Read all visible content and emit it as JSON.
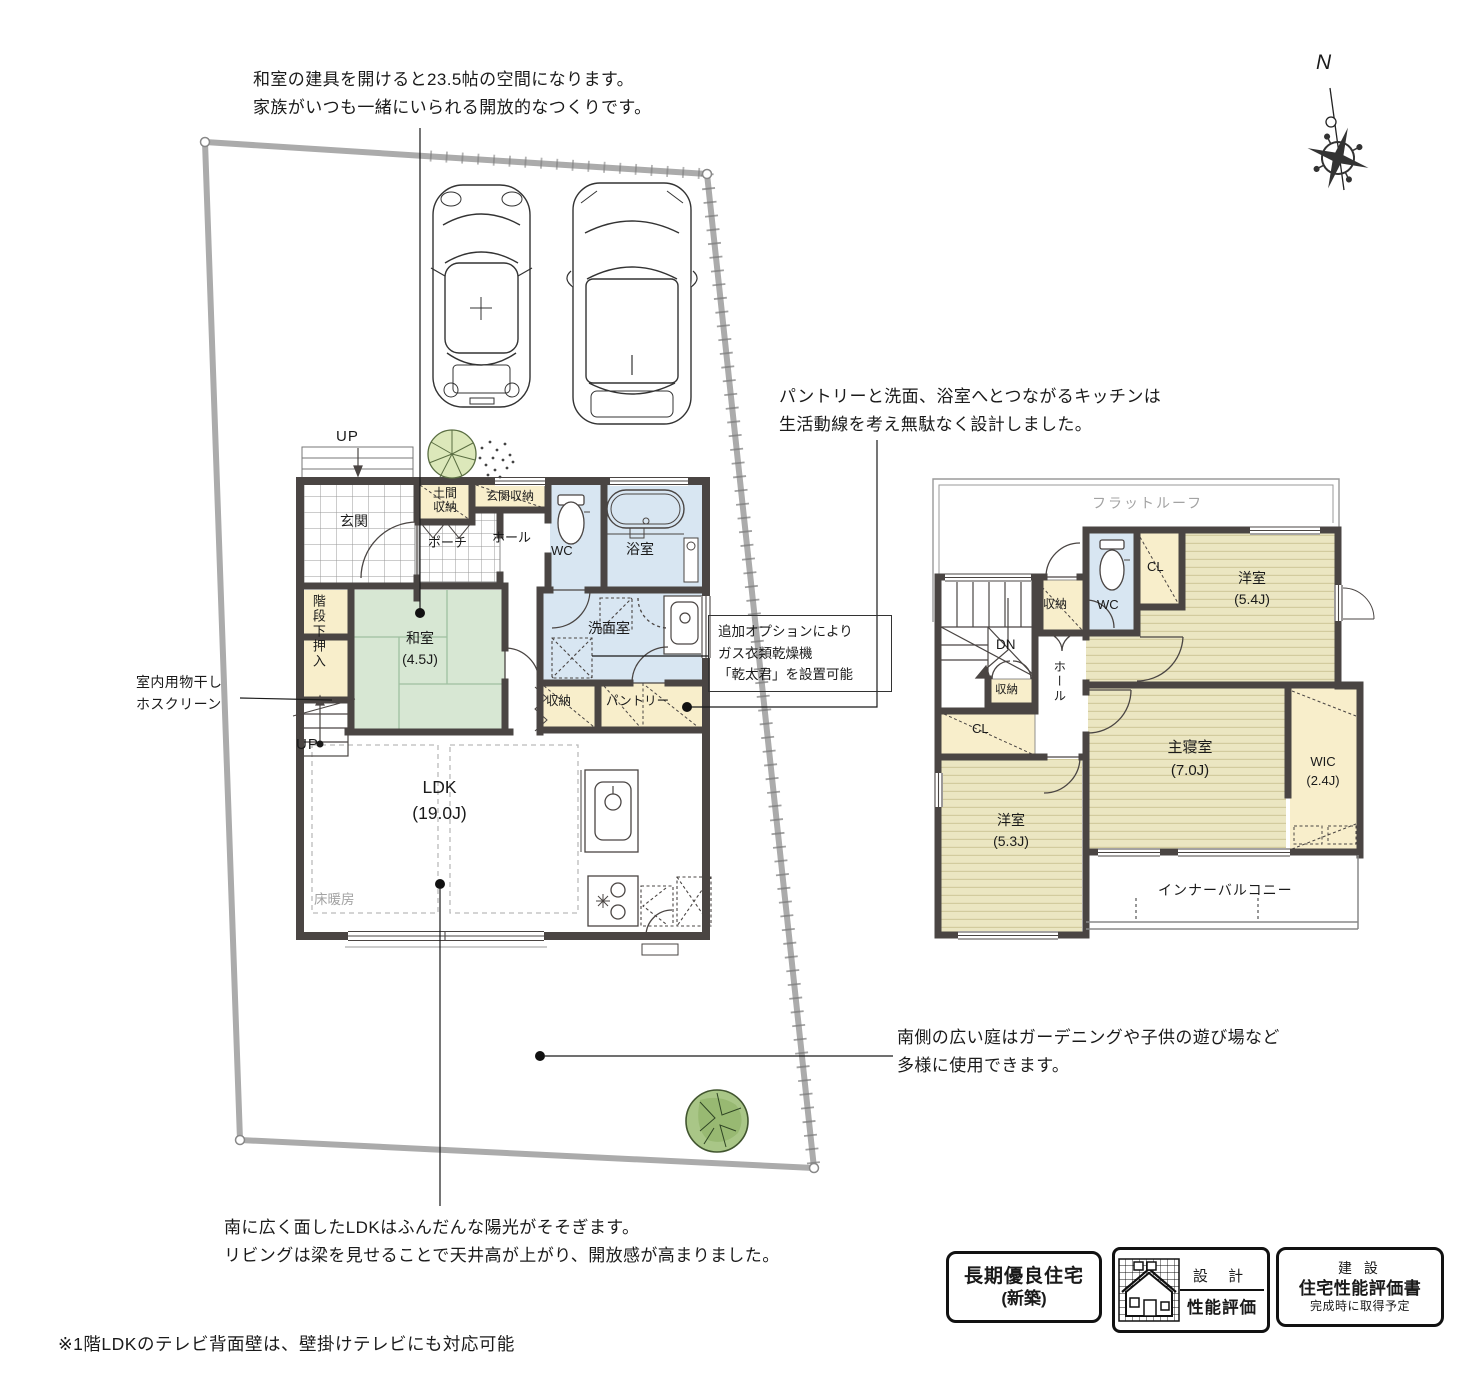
{
  "colors": {
    "wall": "#4a4543",
    "tatami_green": "#d7e7d3",
    "wet_blue": "#d8e6f2",
    "storage_beige": "#f8eecb",
    "flooring_yellow": "#ebe6c2",
    "boundary_gray": "#ababab",
    "muted_gray": "#a3a3a3",
    "tree_green": "#a9c687",
    "text_black": "#1a1a1a"
  },
  "annotations": {
    "top_note": "和室の建具を開けると23.5帖の空間になります。\n家族がいつも一緒にいられる開放的なつくりです。",
    "kitchen_note": "パントリーと洗面、浴室へとつながるキッチンは\n生活動線を考え無駄なく設計しました。",
    "option_note": "追加オプションにより\nガス衣類乾燥機\n「乾太君」を設置可能",
    "hoscreen_note": "室内用物干し\nホスクリーン",
    "garden_note": "南側の広い庭はガーデニングや子供の遊び場など\n多様に使用できます。",
    "ldk_note": "南に広く面したLDKはふんだんな陽光がそそぎます。\nリビングは梁を見せることで天井高が上がり、開放感が高まりました。",
    "footnote": "※1階LDKのテレビ背面壁は、壁掛けテレビにも対応可能"
  },
  "floor1": {
    "labels": {
      "up_north": "UP",
      "genkan": "玄関",
      "doma_shuunou": "土間\n収納",
      "genkan_shuunou": "玄関収納",
      "porch": "ポーチ",
      "hall": "ホール",
      "wc": "WC",
      "bath": "浴室",
      "senmenshitsu": "洗面室",
      "washitsu": "和室\n(4.5J)",
      "kaidanshita_oshiire": "階段下押入",
      "up_stairs": "UP",
      "shuunou": "収納",
      "pantry": "パントリー",
      "ldk": "LDK\n(19.0J)",
      "yukadanbou": "床暖房"
    }
  },
  "floor2": {
    "labels": {
      "flat_roof": "フラットルーフ",
      "dn": "DN",
      "shuunou_a": "収納",
      "wc": "WC",
      "cl_a": "CL",
      "yoshitsu_54": "洋室\n(5.4J)",
      "hall": "ホール",
      "shuunou_b": "収納",
      "cl_b": "CL",
      "yoshitsu_53": "洋室\n(5.3J)",
      "sh_shinshitsu": "主寝室\n(7.0J)",
      "wic": "WIC\n(2.4J)",
      "inner_balcony": "インナーバルコニー"
    }
  },
  "compass": {
    "north": "N"
  },
  "badges": {
    "choki_line1": "長期優良住宅",
    "choki_line2": "(新築)",
    "sekkei_top": "設 計",
    "sekkei_bottom": "性能評価",
    "kensetsu_line1": "建 設",
    "kensetsu_line2": "住宅性能評価書",
    "kensetsu_line3": "完成時に取得予定"
  }
}
